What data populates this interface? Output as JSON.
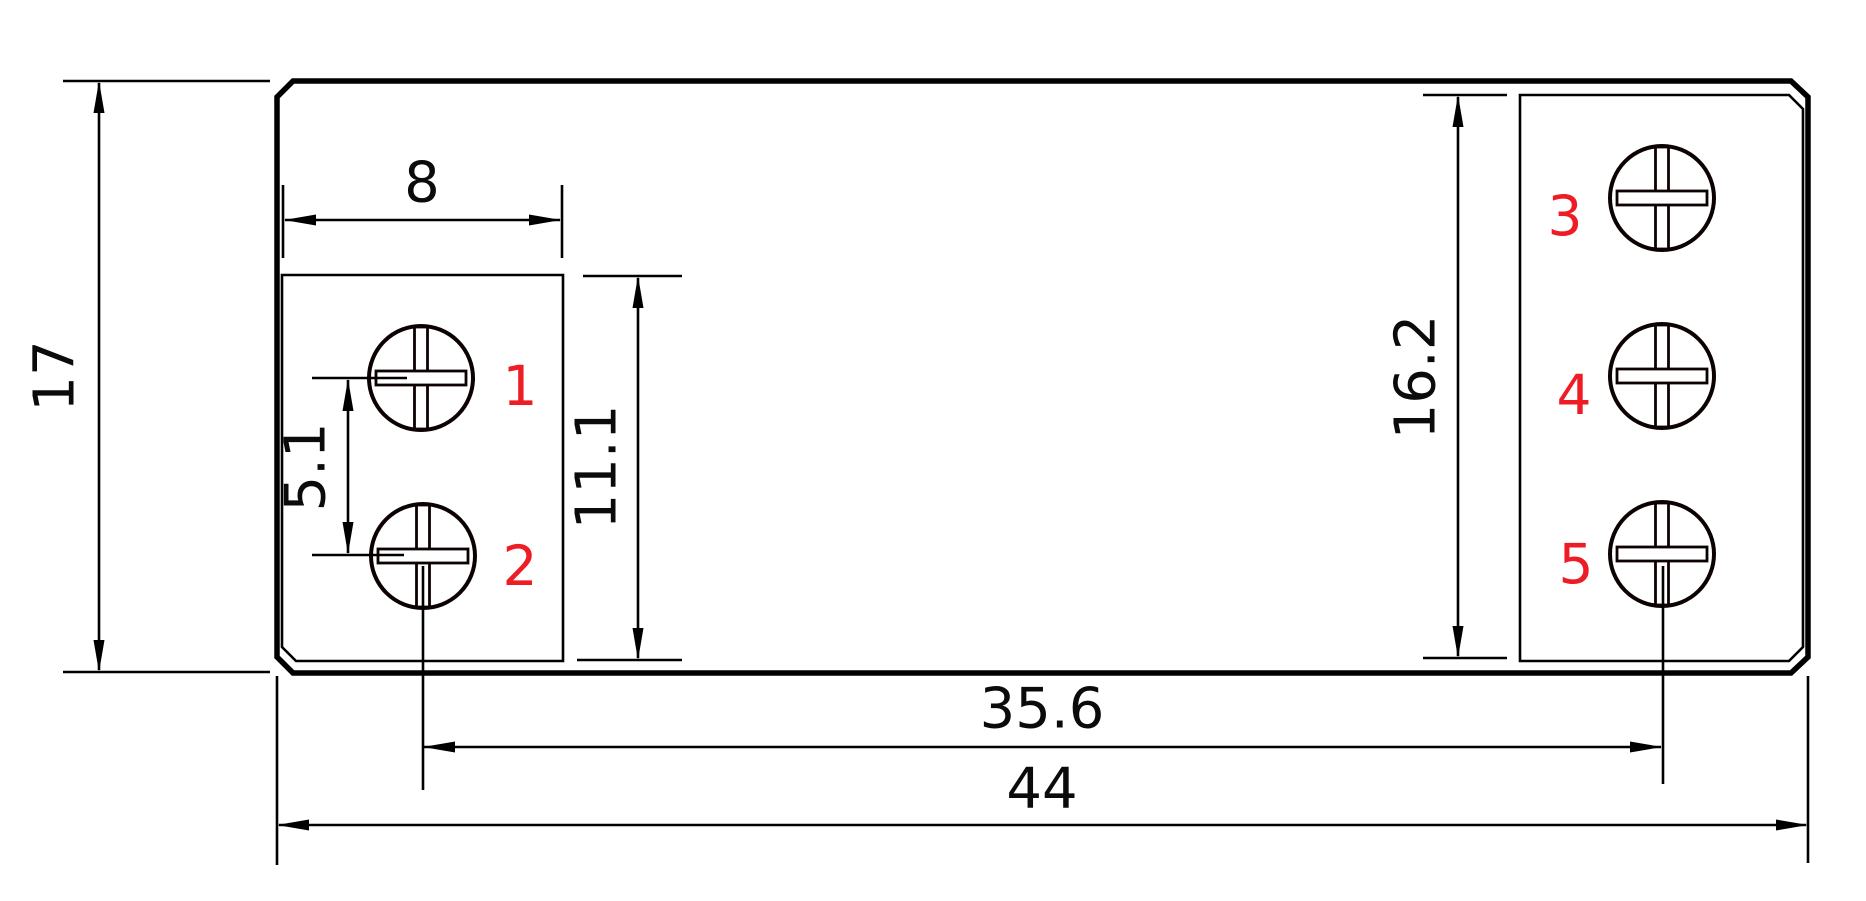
{
  "drawing": {
    "type": "technical-dimension-drawing",
    "units": "mm",
    "background_color": "#ffffff",
    "line_color": "#000000",
    "terminal_number_color": "#ee1c25",
    "dimensions": [
      {
        "id": "overall-height",
        "label": "17",
        "orientation": "vertical"
      },
      {
        "id": "left-box-width",
        "label": "8",
        "orientation": "horizontal"
      },
      {
        "id": "left-screw-pitch",
        "label": "5.1",
        "orientation": "vertical"
      },
      {
        "id": "left-box-height",
        "label": "11.1",
        "orientation": "vertical"
      },
      {
        "id": "right-box-height",
        "label": "16.2",
        "orientation": "vertical"
      },
      {
        "id": "screw-span",
        "label": "35.6",
        "orientation": "horizontal"
      },
      {
        "id": "overall-width",
        "label": "44",
        "orientation": "horizontal"
      }
    ],
    "terminals": [
      {
        "number": "1"
      },
      {
        "number": "2"
      },
      {
        "number": "3"
      },
      {
        "number": "4"
      },
      {
        "number": "5"
      }
    ]
  }
}
